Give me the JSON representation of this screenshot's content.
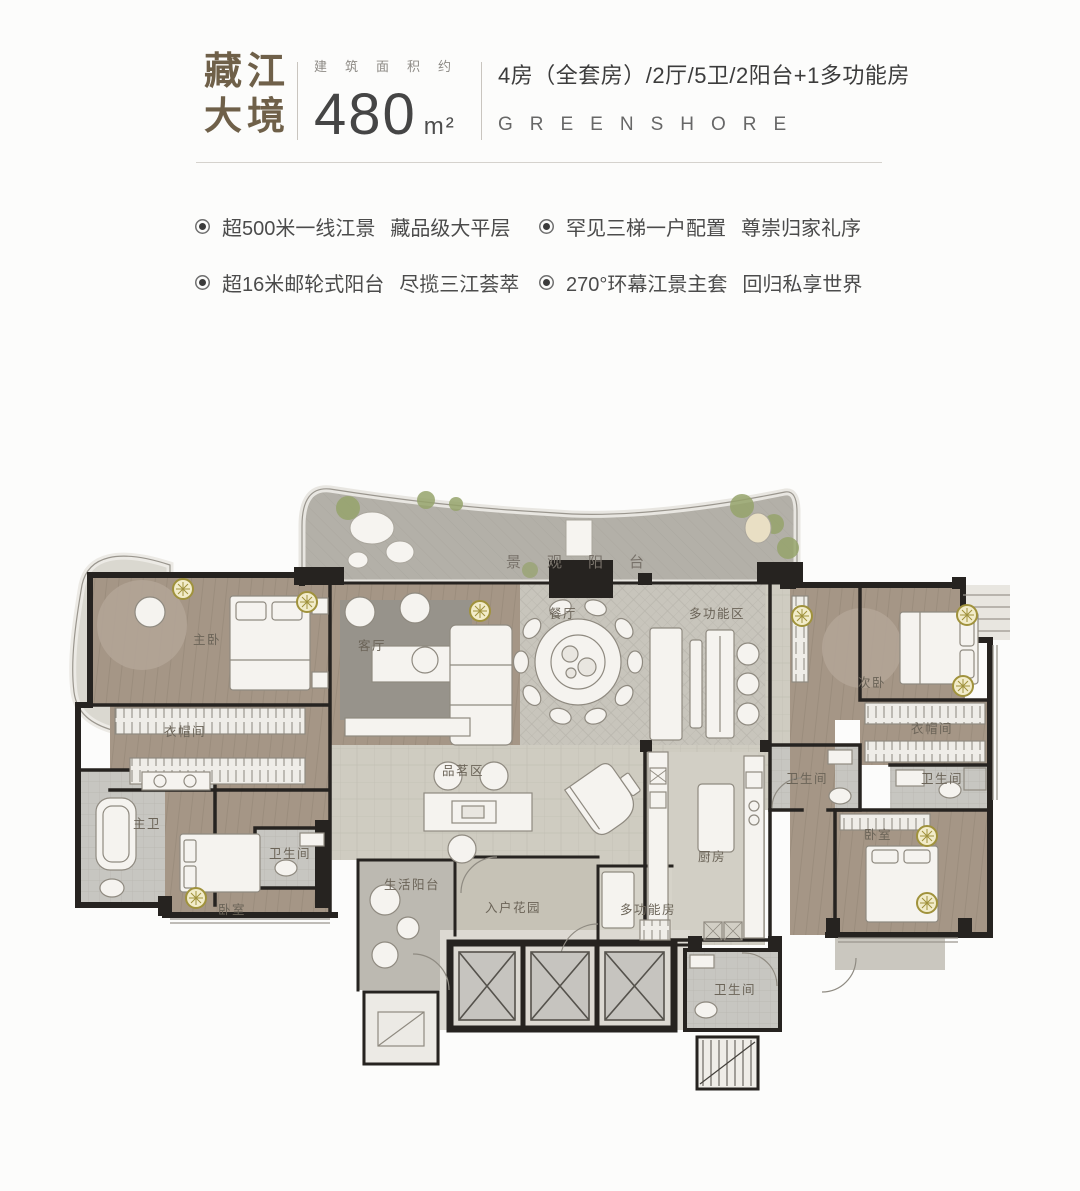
{
  "header": {
    "brand_cn_line1": "藏江",
    "brand_cn_line2": "大境",
    "area_label": "建筑面积约",
    "area_value": "480",
    "area_unit": "m²",
    "config_line": "4房（全套房）/2厅/5卫/2阳台+1多功能房",
    "brand_en": "GREENSHORE",
    "accent_color": "#6f6049"
  },
  "features": [
    {
      "part1": "超500米一线江景",
      "part2": "藏品级大平层"
    },
    {
      "part1": "罕见三梯一户配置",
      "part2": "尊崇归家礼序"
    },
    {
      "part1": "超16米邮轮式阳台",
      "part2": "尽揽三江荟萃"
    },
    {
      "part1": "270°环幕江景主套",
      "part2": "回归私享世界"
    }
  ],
  "floorplan": {
    "rooms": {
      "view_balcony": "景观阳台",
      "master_bedroom": "主卧",
      "closet_master": "衣帽间",
      "living_room": "客厅",
      "dining_room": "餐厅",
      "multi_zone": "多功能区",
      "second_bedroom": "次卧",
      "closet_right": "衣帽间",
      "bath_mid": "卫生间",
      "bath_right": "卫生间",
      "master_bath": "主卫",
      "bath_left": "卫生间",
      "bedroom_left": "卧室",
      "tea_zone": "品茗区",
      "service_balcony": "生活阳台",
      "entry_garden": "入户花园",
      "multi_room": "多功能房",
      "kitchen": "厨房",
      "bedroom_right": "卧室",
      "bath_lobby": "卫生间"
    },
    "colors": {
      "wall": "#262320",
      "wood_floor": "#a59686",
      "tile_floor": "#c8c5bc",
      "stone_floor": "#cfccc1",
      "bath_floor": "#c7c6c1",
      "balcony_floor": "#b3b0a8",
      "garden_floor": "#c6c2b6",
      "kitchen_floor": "#d2cfc5",
      "gold_accent": "#a0923c"
    }
  }
}
